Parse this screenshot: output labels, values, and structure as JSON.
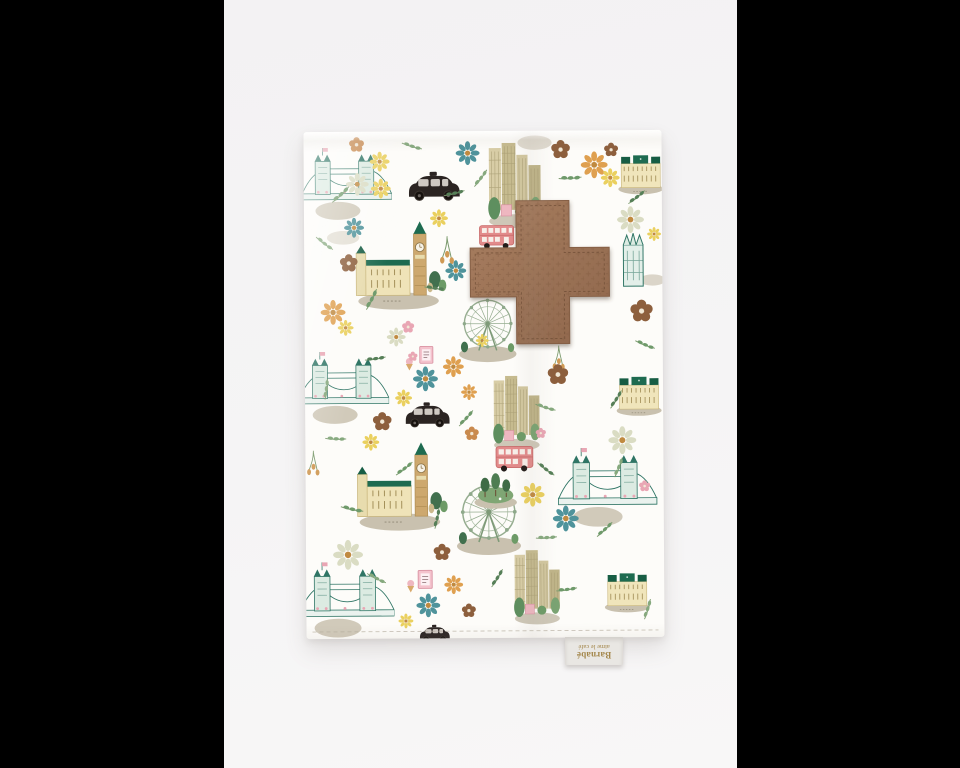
{
  "scene": {
    "type": "product-photo",
    "description": "Folded white fabric book cover with London-landmarks floral print, brown leather cross applique and woven brand tag, centered on pale grey backdrop with black pillarbox bars",
    "letterbox_color": "#000000",
    "backdrop_color": "#f5f4f5"
  },
  "fabric": {
    "base_color": "#fdfcf9",
    "print_name": "London landmarks and flowers",
    "palette": {
      "bridge_teal": "#2f7565",
      "roof_green": "#1e6b50",
      "facade_cream": "#efe3b8",
      "tower_tan": "#cda86e",
      "taxi_black": "#2b2422",
      "bus_red": "#e28b8b",
      "wheel_sage": "#96ad90",
      "ground_taupe": "#c9c1af",
      "flower_yellow": "#ead05f",
      "flower_orange": "#dfa050",
      "flower_teal": "#4f939b",
      "flower_brown": "#8d5f3d",
      "flower_pink": "#e9a6b4",
      "leaf_green": "#6f9a6b"
    },
    "bottom_stitch_color": "#b7afa0",
    "motifs": [
      {
        "t": "cloud",
        "x": 186,
        "y": 3,
        "w": 90,
        "h": 18,
        "o": 0.55
      },
      {
        "t": "cloud",
        "x": 22,
        "y": 95,
        "w": 34,
        "h": 22,
        "o": 0.5
      },
      {
        "t": "cloud",
        "x": 334,
        "y": 130,
        "w": 28,
        "h": 40,
        "o": 0.65
      },
      {
        "t": "bridge",
        "x": -2,
        "y": 2,
        "w": 90,
        "h": 100
      },
      {
        "t": "bridge",
        "x": -6,
        "y": 206,
        "w": 90,
        "h": 100
      },
      {
        "t": "bridge",
        "x": 245,
        "y": 316,
        "w": 114,
        "h": 82
      },
      {
        "t": "bridge",
        "x": -6,
        "y": 427,
        "w": 94,
        "h": 82
      },
      {
        "t": "bigben",
        "x": 50,
        "y": 89,
        "w": 92,
        "h": 92
      },
      {
        "t": "bigben",
        "x": 50,
        "y": 310,
        "w": 92,
        "h": 92
      },
      {
        "t": "mansion",
        "x": 313,
        "y": 9,
        "w": 48,
        "h": 64
      },
      {
        "t": "mansion",
        "x": 310,
        "y": 230,
        "w": 48,
        "h": 65
      },
      {
        "t": "mansion",
        "x": 297,
        "y": 427,
        "w": 48,
        "h": 64
      },
      {
        "t": "skyline",
        "x": 179,
        "y": 12,
        "w": 64,
        "h": 86
      },
      {
        "t": "skyline",
        "x": 184,
        "y": 245,
        "w": 55,
        "h": 76
      },
      {
        "t": "skyline",
        "x": 207,
        "y": 418,
        "w": 48,
        "h": 78
      },
      {
        "t": "ferris",
        "x": 144,
        "y": 164,
        "w": 78,
        "h": 68
      },
      {
        "t": "ferris",
        "x": 143,
        "y": 348,
        "w": 80,
        "h": 78
      },
      {
        "t": "park",
        "x": 167,
        "y": 340,
        "w": 46,
        "h": 40
      },
      {
        "t": "abbey",
        "x": 309,
        "y": 103,
        "w": 40,
        "h": 57
      },
      {
        "t": "taxi",
        "x": 101,
        "y": 37,
        "w": 58,
        "h": 36
      },
      {
        "t": "taxi",
        "x": 97,
        "y": 268,
        "w": 50,
        "h": 31
      },
      {
        "t": "taxi",
        "x": 111,
        "y": 492,
        "w": 34,
        "h": 20
      },
      {
        "t": "bus",
        "x": 174,
        "y": 93,
        "w": 37,
        "h": 26
      },
      {
        "t": "bus",
        "x": 189,
        "y": 314,
        "w": 40,
        "h": 28
      },
      {
        "t": "sign",
        "x": 114,
        "y": 213,
        "w": 15,
        "h": 21
      },
      {
        "t": "sign",
        "x": 111,
        "y": 438,
        "w": 16,
        "h": 20
      },
      {
        "t": "icecream",
        "x": 100,
        "y": 226,
        "w": 9,
        "h": 14
      },
      {
        "t": "icecream",
        "x": 100,
        "y": 448,
        "w": 9,
        "h": 14
      },
      {
        "t": "bluebell",
        "x": 134,
        "y": 103,
        "w": 18,
        "h": 34,
        "c": "#d09a55"
      },
      {
        "t": "bluebell",
        "x": 244,
        "y": 215,
        "w": 20,
        "h": 26,
        "c": "#d09a55"
      },
      {
        "t": "bluebell",
        "x": 0,
        "y": 318,
        "w": 16,
        "h": 28,
        "c": "#d09a55"
      },
      {
        "t": "leaf",
        "x": 25,
        "y": 55,
        "w": 24,
        "h": 14,
        "c": "#6f9a6b",
        "r": -20
      },
      {
        "t": "leaf",
        "x": 98,
        "y": 8,
        "w": 22,
        "h": 13,
        "c": "#86a97e",
        "r": 40
      },
      {
        "t": "leaf",
        "x": 140,
        "y": 55,
        "w": 22,
        "h": 13,
        "c": "#567f58",
        "r": 10
      },
      {
        "t": "leaf",
        "x": 166,
        "y": 40,
        "w": 22,
        "h": 13,
        "c": "#86a97e",
        "r": -30
      },
      {
        "t": "leaf",
        "x": 255,
        "y": 40,
        "w": 24,
        "h": 14,
        "c": "#6f9a6b",
        "r": 20
      },
      {
        "t": "leaf",
        "x": 322,
        "y": 60,
        "w": 22,
        "h": 13,
        "c": "#567f58",
        "r": -15
      },
      {
        "t": "leaf",
        "x": 10,
        "y": 105,
        "w": 22,
        "h": 13,
        "c": "#86a97e",
        "r": 60
      },
      {
        "t": "leaf",
        "x": 55,
        "y": 160,
        "w": 24,
        "h": 14,
        "c": "#6f9a6b",
        "r": -40
      },
      {
        "t": "leaf",
        "x": 120,
        "y": 150,
        "w": 22,
        "h": 13,
        "c": "#567f58",
        "r": 30
      },
      {
        "t": "leaf",
        "x": 330,
        "y": 208,
        "w": 22,
        "h": 13,
        "c": "#6f9a6b",
        "r": 45
      },
      {
        "t": "leaf",
        "x": 10,
        "y": 250,
        "w": 22,
        "h": 13,
        "c": "#86a97e",
        "r": -60
      },
      {
        "t": "leaf",
        "x": 60,
        "y": 220,
        "w": 22,
        "h": 13,
        "c": "#567f58",
        "r": 15
      },
      {
        "t": "leaf",
        "x": 150,
        "y": 280,
        "w": 22,
        "h": 13,
        "c": "#6f9a6b",
        "r": -25
      },
      {
        "t": "leaf",
        "x": 230,
        "y": 270,
        "w": 22,
        "h": 13,
        "c": "#86a97e",
        "r": 40
      },
      {
        "t": "leaf",
        "x": 300,
        "y": 262,
        "w": 22,
        "h": 13,
        "c": "#567f58",
        "r": -35
      },
      {
        "t": "leaf",
        "x": 20,
        "y": 300,
        "w": 22,
        "h": 13,
        "c": "#86a97e",
        "r": 25
      },
      {
        "t": "leaf",
        "x": 88,
        "y": 330,
        "w": 22,
        "h": 13,
        "c": "#6f9a6b",
        "r": -15
      },
      {
        "t": "leaf",
        "x": 230,
        "y": 332,
        "w": 22,
        "h": 13,
        "c": "#567f58",
        "r": 60
      },
      {
        "t": "leaf",
        "x": 302,
        "y": 330,
        "w": 22,
        "h": 13,
        "c": "#86a97e",
        "r": -45
      },
      {
        "t": "leaf",
        "x": 35,
        "y": 370,
        "w": 24,
        "h": 14,
        "c": "#6f9a6b",
        "r": 35
      },
      {
        "t": "leaf",
        "x": 120,
        "y": 380,
        "w": 22,
        "h": 13,
        "c": "#567f58",
        "r": -55
      },
      {
        "t": "leaf",
        "x": 230,
        "y": 400,
        "w": 22,
        "h": 13,
        "c": "#86a97e",
        "r": 20
      },
      {
        "t": "leaf",
        "x": 288,
        "y": 392,
        "w": 22,
        "h": 13,
        "c": "#6f9a6b",
        "r": -20
      },
      {
        "t": "leaf",
        "x": 60,
        "y": 440,
        "w": 22,
        "h": 13,
        "c": "#86a97e",
        "r": 50
      },
      {
        "t": "leaf",
        "x": 180,
        "y": 440,
        "w": 22,
        "h": 13,
        "c": "#567f58",
        "r": -35
      },
      {
        "t": "leaf",
        "x": 250,
        "y": 452,
        "w": 22,
        "h": 13,
        "c": "#6f9a6b",
        "r": 15
      },
      {
        "t": "leaf",
        "x": 330,
        "y": 472,
        "w": 22,
        "h": 13,
        "c": "#86a97e",
        "r": -50
      },
      {
        "t": "flower8",
        "x": 66,
        "y": 20,
        "w": 20,
        "h": 20,
        "c": "#ead05f"
      },
      {
        "t": "flower8",
        "x": 67,
        "y": 47,
        "w": 20,
        "h": 20,
        "c": "#ead05f"
      },
      {
        "t": "flower8",
        "x": 42,
        "y": 41,
        "w": 23,
        "h": 23,
        "c": "#dadcc3"
      },
      {
        "t": "flower8",
        "x": 152,
        "y": 10,
        "w": 24,
        "h": 24,
        "c": "#4f939b"
      },
      {
        "t": "flower8",
        "x": 126,
        "y": 78,
        "w": 18,
        "h": 18,
        "c": "#ead05f"
      },
      {
        "t": "flower8",
        "x": 277,
        "y": 21,
        "w": 27,
        "h": 27,
        "c": "#dfa050"
      },
      {
        "t": "flower8",
        "x": 297,
        "y": 38,
        "w": 19,
        "h": 19,
        "c": "#ead05f"
      },
      {
        "t": "flower8",
        "x": 16,
        "y": 168,
        "w": 25,
        "h": 25,
        "c": "#dfa050"
      },
      {
        "t": "flower8",
        "x": 33,
        "y": 188,
        "w": 16,
        "h": 16,
        "c": "#ead05f"
      },
      {
        "t": "flower8",
        "x": 141,
        "y": 129,
        "w": 21,
        "h": 21,
        "c": "#4f939b"
      },
      {
        "t": "flower8",
        "x": 313,
        "y": 76,
        "w": 27,
        "h": 27,
        "c": "#dadcc3"
      },
      {
        "t": "flower8",
        "x": 40,
        "y": 86,
        "w": 20,
        "h": 20,
        "c": "#4f939b"
      },
      {
        "t": "flower8",
        "x": 343,
        "y": 97,
        "w": 14,
        "h": 14,
        "c": "#ead05f"
      },
      {
        "t": "flower8",
        "x": 138,
        "y": 225,
        "w": 21,
        "h": 21,
        "c": "#dfa050"
      },
      {
        "t": "flower8",
        "x": 108,
        "y": 235,
        "w": 25,
        "h": 25,
        "c": "#4f939b"
      },
      {
        "t": "flower8",
        "x": 90,
        "y": 258,
        "w": 17,
        "h": 17,
        "c": "#ead05f"
      },
      {
        "t": "flower8",
        "x": 156,
        "y": 253,
        "w": 16,
        "h": 16,
        "c": "#dfa050"
      },
      {
        "t": "flower8",
        "x": 82,
        "y": 196,
        "w": 19,
        "h": 19,
        "c": "#dadcc3"
      },
      {
        "t": "flower8",
        "x": 171,
        "y": 203,
        "w": 13,
        "h": 13,
        "c": "#ead05f"
      },
      {
        "t": "flower8",
        "x": 215,
        "y": 352,
        "w": 24,
        "h": 24,
        "c": "#ead05f"
      },
      {
        "t": "flower8",
        "x": 247,
        "y": 375,
        "w": 26,
        "h": 26,
        "c": "#4f939b"
      },
      {
        "t": "flower8",
        "x": 303,
        "y": 296,
        "w": 28,
        "h": 28,
        "c": "#dadcc3"
      },
      {
        "t": "flower8",
        "x": 27,
        "y": 408,
        "w": 30,
        "h": 30,
        "c": "#dadcc3"
      },
      {
        "t": "flower8",
        "x": 57,
        "y": 302,
        "w": 17,
        "h": 17,
        "c": "#ead05f"
      },
      {
        "t": "flower8",
        "x": 110,
        "y": 462,
        "w": 24,
        "h": 24,
        "c": "#4f939b"
      },
      {
        "t": "flower8",
        "x": 92,
        "y": 482,
        "w": 15,
        "h": 15,
        "c": "#ead05f"
      },
      {
        "t": "flower8",
        "x": 138,
        "y": 444,
        "w": 19,
        "h": 19,
        "c": "#dfa050"
      },
      {
        "t": "bloom5",
        "x": 247,
        "y": 9,
        "w": 20,
        "h": 20,
        "c": "#8d5f3d"
      },
      {
        "t": "bloom5",
        "x": 300,
        "y": 12,
        "w": 15,
        "h": 15,
        "c": "#8d5f3d"
      },
      {
        "t": "bloom5",
        "x": 35,
        "y": 122,
        "w": 19,
        "h": 19,
        "c": "#8d5f3d"
      },
      {
        "t": "bloom5",
        "x": 325,
        "y": 169,
        "w": 24,
        "h": 24,
        "c": "#8d5f3d"
      },
      {
        "t": "bloom5",
        "x": 242,
        "y": 233,
        "w": 22,
        "h": 22,
        "c": "#8d5f3d"
      },
      {
        "t": "bloom5",
        "x": 67,
        "y": 280,
        "w": 20,
        "h": 20,
        "c": "#8d5f3d"
      },
      {
        "t": "bloom5",
        "x": 127,
        "y": 412,
        "w": 18,
        "h": 18,
        "c": "#8d5f3d"
      },
      {
        "t": "bloom5",
        "x": 155,
        "y": 472,
        "w": 15,
        "h": 15,
        "c": "#8d5f3d"
      },
      {
        "t": "bloom5",
        "x": 159,
        "y": 295,
        "w": 15,
        "h": 15,
        "c": "#c98a4e"
      },
      {
        "t": "bloom5",
        "x": 45,
        "y": 5,
        "w": 16,
        "h": 16,
        "c": "#c98a4e"
      },
      {
        "t": "bloom5",
        "x": 103,
        "y": 220,
        "w": 10,
        "h": 10,
        "c": "#e9a6b4"
      },
      {
        "t": "bloom5",
        "x": 97,
        "y": 189,
        "w": 13,
        "h": 13,
        "c": "#e9a6b4"
      },
      {
        "t": "bloom5",
        "x": 230,
        "y": 297,
        "w": 11,
        "h": 11,
        "c": "#e9a6b4"
      },
      {
        "t": "bloom5",
        "x": 333,
        "y": 350,
        "w": 12,
        "h": 12,
        "c": "#e9a6b4"
      }
    ]
  },
  "cross": {
    "x": 166,
    "y": 70,
    "w": 139,
    "h": 143,
    "vx": 212,
    "vw": 53,
    "hy": 117,
    "hh": 49,
    "leather_color": "#9d7458",
    "leather_light": "#a87e60",
    "leather_dark": "#8f674c",
    "stitch_color": "#6e4c34",
    "emboss_color": "#7a563c"
  },
  "tag": {
    "lines": [
      "Barnabé",
      "aime le café"
    ],
    "background": "#e9e7e3",
    "text_color": "#a3864a",
    "rotated_degrees": 180
  }
}
